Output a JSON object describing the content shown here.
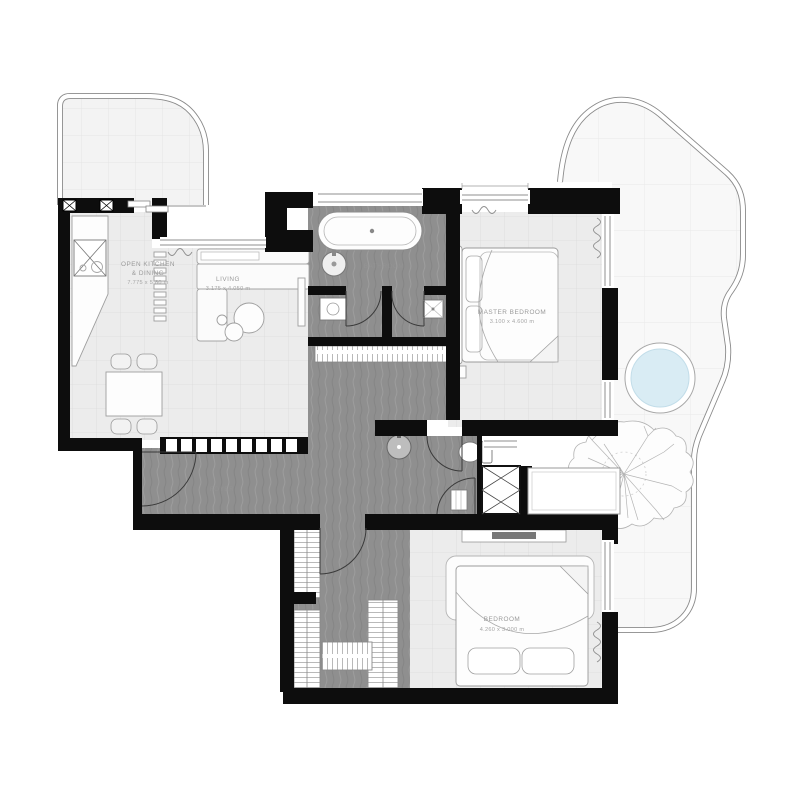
{
  "plan_title": "apartment-floor-plan",
  "colors": {
    "wall": "#0d0d0d",
    "floor_light": "#ececec",
    "floor_grid": "#dbdbdb",
    "floor_dark": "#8f8f8f",
    "balcony_tile": "#f3f3f3",
    "terrace_tile": "#f8f8f8",
    "terrace_grid": "#e9e9e9",
    "pool_fill": "#d9ecf4",
    "outline": "#8a8a8a",
    "label": "#9a9a9a"
  },
  "rooms": {
    "kitchen": {
      "name_line1": "OPEN KITCHEN",
      "name_line2": "& DINING",
      "dimensions": "7.775 x 5.80 m"
    },
    "living": {
      "name": "LIVING",
      "dimensions": "3.175 x 4.050 m"
    },
    "master_bedroom": {
      "name": "MASTER BEDROOM",
      "dimensions": "3.100 x 4.600 m"
    },
    "bedroom": {
      "name": "BEDROOM",
      "dimensions": "4.260 x 3.000 m"
    },
    "bathroom": {
      "name": "BATHROOM"
    },
    "foyer": {
      "name": "FOYER"
    }
  }
}
